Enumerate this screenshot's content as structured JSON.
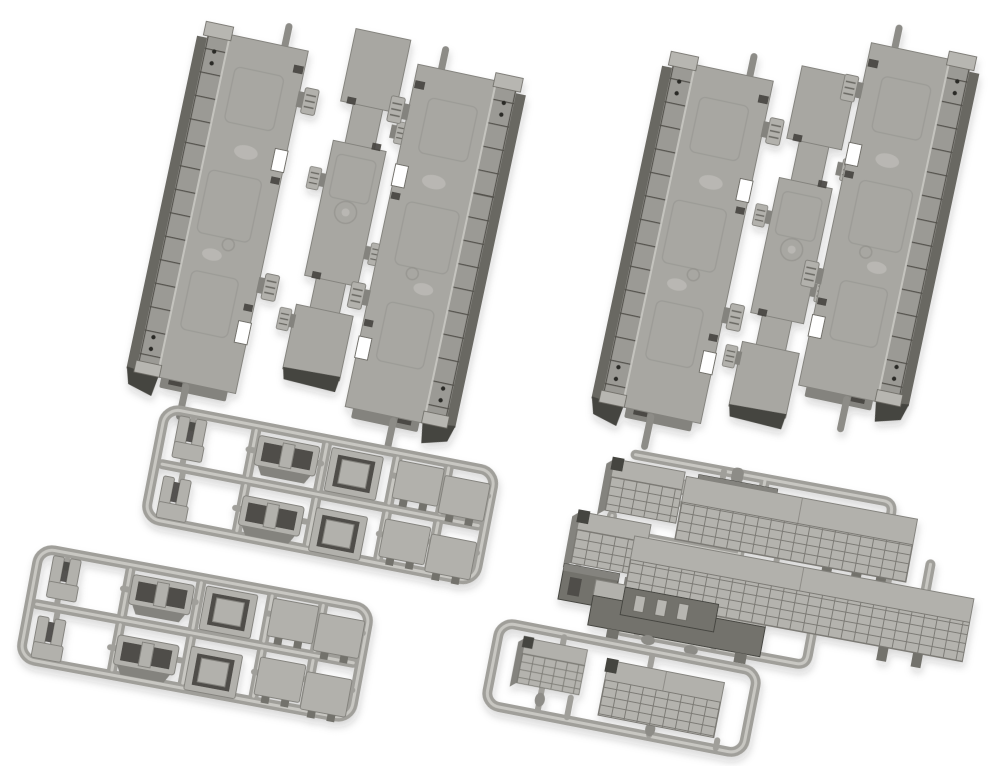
{
  "image": {
    "title": "Gray plastic model-railway parts set",
    "description": "Product photo on a white background of gray injection-molded model train parts: two sets of three slanted underbody floor pieces across the top, two identical small-parts sprues at the lower left, an equipment sprue with louvered boxes and grilles at the lower right, and a small sprue holding two louvered panels at the bottom center.",
    "background": "#ffffff"
  },
  "objects": {
    "floor_set_left": {
      "label": "Floor piece set (top left)",
      "pieces": 3,
      "arrangement": "wide piece, narrow center strip, wide piece, all tilted"
    },
    "floor_set_right": {
      "label": "Floor piece set (top right)",
      "pieces": 3,
      "arrangement": "wide piece, narrow center strip, wide piece, all tilted"
    },
    "parts_sprue_upper": {
      "label": "Small parts sprue (upper left)",
      "parts": [
        "L-bracket x2",
        "coupler cover x2",
        "hatch cover x2",
        "flat square panel x4"
      ]
    },
    "parts_sprue_lower": {
      "label": "Small parts sprue (lower left)",
      "parts": [
        "L-bracket x2",
        "coupler cover x2",
        "hatch cover x2",
        "flat square panel x4"
      ]
    },
    "equipment_sprue": {
      "label": "Underfloor equipment sprue (right)",
      "parts": [
        "louver grille x2",
        "equipment block x2",
        "long underfloor tank x1",
        "louvered roof panel x2"
      ]
    },
    "louver_sprue": {
      "label": "Louvered panel sprue (bottom center)",
      "parts": [
        "small louvered panel x1",
        "large louvered panel x1"
      ]
    }
  },
  "colors": {
    "bg": "#ffffff",
    "plate": "#a8a7a2",
    "plate_hi": "#c9c8c3",
    "plate_dark": "#84837e",
    "part_light": "#b2b1ac",
    "rail_face": "#9b9a95",
    "rail_edge": "#696862",
    "rail_line": "#54534d",
    "rail_cap": "#b7b6b1",
    "runner": "#a09f9a",
    "runner_hi": "#cfcec9",
    "recess": "#4f4e48",
    "block_dark": "#73726c",
    "end_dark": "#45443f",
    "louver_fill": "#b4b3ae",
    "louver_line": "#7b7a74",
    "mold_line": "#8f8e89",
    "notch_line": "#6f6e68",
    "pin": "#8d8c87",
    "hole": "#2b2a26"
  }
}
